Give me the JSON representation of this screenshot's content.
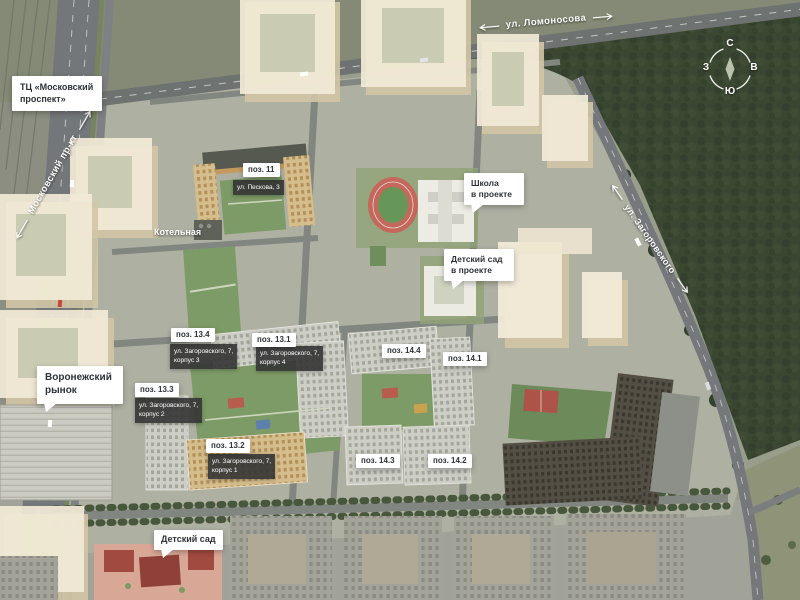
{
  "labels": {
    "tc": "ТЦ «Московский\nпроспект»",
    "boiler": "Котельная",
    "school": "Школа\nв проекте",
    "kindergarten_project": "Детский сад\nв проекте",
    "market": "Воронежский\nрынок",
    "kindergarten": "Детский сад"
  },
  "streets": {
    "lomonosova": "ул. Ломоносова",
    "moskovsky": "Московский пр-кт",
    "zagorovskogo": "ул. Загоровского"
  },
  "positions": {
    "p11": {
      "pos": "поз. 11",
      "addr": "ул. Пескова, 3"
    },
    "p134": {
      "pos": "поз. 13.4",
      "addr": "ул. Загоровского, 7,\nкорпус 3"
    },
    "p131": {
      "pos": "поз. 13.1",
      "addr": "ул. Загоровского, 7,\nкорпус 4"
    },
    "p133": {
      "pos": "поз. 13.3",
      "addr": "ул. Загоровского, 7,\nкорпус 2"
    },
    "p132": {
      "pos": "поз. 13.2",
      "addr": "ул. Загоровского, 7,\nкорпус 1"
    },
    "p144": {
      "pos": "поз. 14.4"
    },
    "p141": {
      "pos": "поз. 14.1"
    },
    "p143": {
      "pos": "поз. 14.3"
    },
    "p142": {
      "pos": "поз. 14.2"
    }
  },
  "compass": {
    "n": "С",
    "e": "В",
    "s": "Ю",
    "w": "З"
  },
  "colors": {
    "forest": "#3a4731",
    "road": "#75787a",
    "ghost_building": "#f1e9d6",
    "courtyard_green": "#7d9b66",
    "track_red": "#c4685c",
    "label_dark": "#343434"
  }
}
